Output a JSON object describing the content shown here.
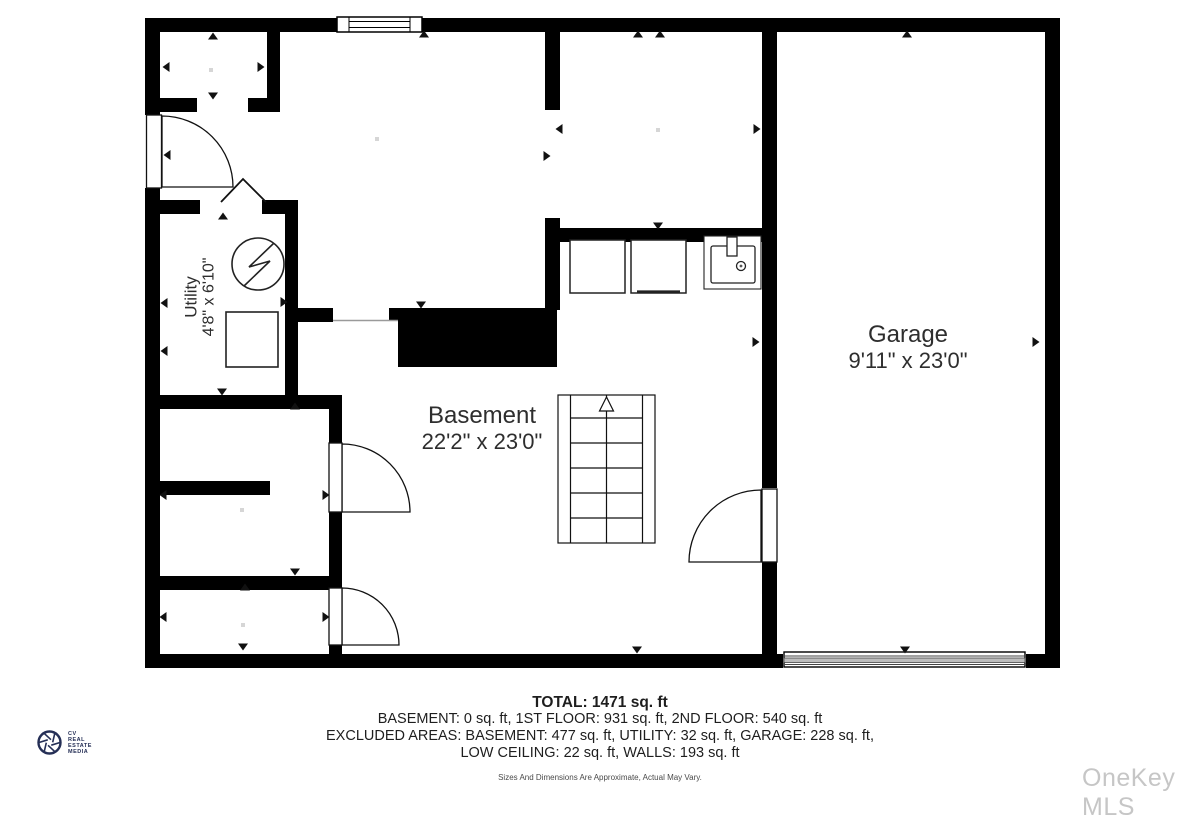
{
  "plan": {
    "rooms": [
      {
        "name": "Utility",
        "dimensions": "4'8\" x 6'10\""
      },
      {
        "name": "Basement",
        "dimensions": "22'2\" x 23'0\""
      },
      {
        "name": "Garage",
        "dimensions": "9'11\" x 23'0\""
      }
    ]
  },
  "summary": {
    "total": "TOTAL: 1471 sq. ft",
    "line1": "BASEMENT: 0 sq. ft, 1ST FLOOR: 931 sq. ft, 2ND FLOOR: 540 sq. ft",
    "line2": "EXCLUDED AREAS: BASEMENT: 477 sq. ft, UTILITY: 32 sq. ft, GARAGE: 228 sq. ft,",
    "line3": "LOW CEILING: 22 sq. ft, WALLS: 193 sq. ft",
    "disclaimer": "Sizes And Dimensions Are Approximate, Actual May Vary."
  },
  "branding": {
    "logo": {
      "l1": "CV",
      "l2": "REAL",
      "l3": "ESTATE",
      "l4": "MEDIA"
    },
    "watermark": "OneKey MLS"
  },
  "colors": {
    "wall": "#000000",
    "text": "#2e2e2e",
    "watermark": "#c6c6c6",
    "logo": "#252f56"
  }
}
